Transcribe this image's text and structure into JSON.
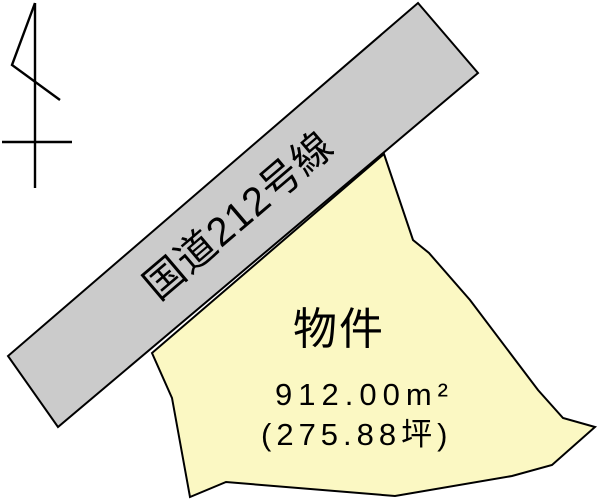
{
  "canvas": {
    "background": "#ffffff",
    "line_color": "#000000"
  },
  "road": {
    "label": "国道212号線",
    "fill": "#cbcbcb",
    "stroke": "#000000",
    "points": "418,3 478,73 58,427 8,356"
  },
  "parcel": {
    "name": "物件",
    "area_m2": "912.00m²",
    "area_tsubo": "(275.88坪)",
    "fill": "#fbf8c3",
    "stroke": "#000000",
    "points": "384,154 413,240 429,253 470,300 538,390 563,418 595,427 552,465 512,476 395,496 226,482 190,497 172,398 152,353"
  },
  "north_arrow": {
    "stroke": "#000000",
    "shaft_path": "M35,3 L35,188",
    "flag_path": "M35,3 L12,65 L60,100",
    "crossbar_path": "M2,142 L72,142"
  }
}
